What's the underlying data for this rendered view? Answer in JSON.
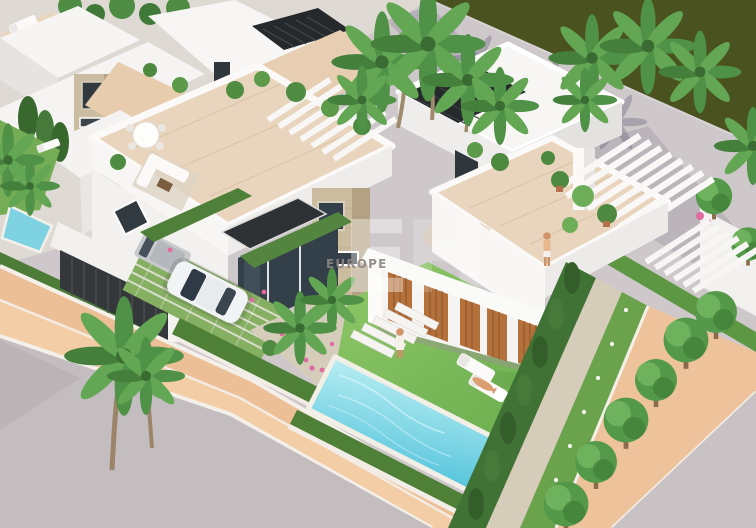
{
  "scene": {
    "kind": "aerial-3d-architectural-render",
    "subject": "Modern white villas with rooftop terraces, private pool, palm trees, promenade and canal",
    "watermark": {
      "brand_text": "EUROPE",
      "logo_letter_1": "E",
      "logo_letter_2": "H"
    },
    "palette": {
      "water_band": "#4a5220",
      "promenade": "#cfc8cb",
      "road_left": "#c4bdc0",
      "road_right": "#c9c2c5",
      "sidewalk": "#edbf97",
      "sidewalk_inner": "#f3cda6",
      "walkway_right": "#eec39c",
      "curb": "#f4f0e9",
      "villa_white": "#f7f6f4",
      "wall_shade": "#eceae8",
      "terrace_tile": "#e9d5bd",
      "stone_tower": "#cbbc9f",
      "pergola_dark": "#26292c",
      "glass_dark": "#33404a",
      "louver_wood": "#b5713c",
      "deck_wood": "#a0744a",
      "pool_water": "#8fdce9",
      "pool_coping": "#f2efe7",
      "lawn": "#7fbb5c",
      "hedge": "#4e8038",
      "hedge_bright": "#5d9743",
      "cypress": "#3f7234",
      "tree_green": "#54994a",
      "palm_green": "#4f9147",
      "gravel": "#d6ccba",
      "flower_pink": "#e06ba1",
      "skin": "#dc9e70",
      "car_white": "#f1f3f5",
      "van_gray": "#c7cacd",
      "watermark_gray": "#8b8683"
    }
  }
}
